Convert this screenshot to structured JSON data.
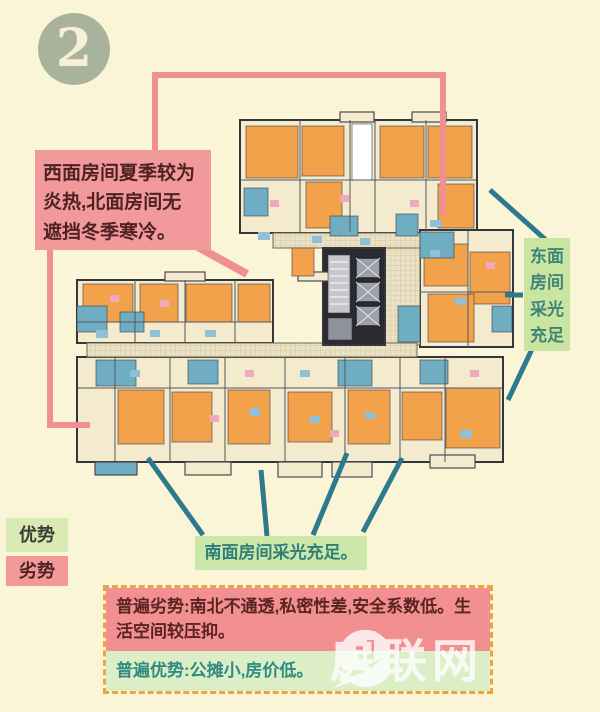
{
  "page": {
    "background": "#FBF5D8"
  },
  "badge": {
    "number": "2",
    "bg": "#A9B39B",
    "fg": "#F6F1D6"
  },
  "annotations": {
    "west_north": {
      "text": "西面房间夏季较为\n炎热,北面房间无\n遮挡冬季寒冷。",
      "bg": "#F29A9B",
      "fg": "#4D2221"
    },
    "east": {
      "text": "东面\n房间\n采光\n充足",
      "bg": "#CAE5A1",
      "fg": "#3E8577"
    },
    "south": {
      "text": "南面房间采光充足。",
      "bg": "#CBE7A9",
      "fg": "#2F7F78"
    }
  },
  "legend": {
    "advantage": {
      "label": "优势",
      "bg": "#D9EBB4",
      "fg": "#3C3C34"
    },
    "disadvantage": {
      "label": "劣势",
      "bg": "#F29899",
      "fg": "#4D2221"
    }
  },
  "summary": {
    "border_color": "#E9A53F",
    "disadvantage": {
      "text": "普遍劣势:南北不通透,私密性差,安全系数低。生活空间较压抑。",
      "bg": "#F28F90",
      "fg": "#5A2422"
    },
    "advantage": {
      "text": "普遍优势:公摊小,房价低。",
      "bg": "#DCEEC5",
      "fg": "#2F8A80"
    }
  },
  "watermark": {
    "text": "房联网",
    "color": "#FFFFFF"
  },
  "colors": {
    "c": "#F4EBCE",
    "o": "#F2A24A",
    "t": "#6FAEC2",
    "d": "#2A2A31",
    "w": "#FFFFFF",
    "h": "url(#hatch)",
    "g1": "#C6C6CC",
    "g2": "#9DA0A8",
    "g3": "#8F929B",
    "fb": "#8FC0D8",
    "fp": "#F0A8BC",
    "pink_line": "#F09092",
    "teal_line": "#2C7A8C"
  },
  "floorplan": {
    "blocks": [
      {
        "x": 240,
        "y": 120,
        "w": 237,
        "h": 113,
        "f": "c"
      },
      {
        "x": 420,
        "y": 230,
        "w": 93,
        "h": 117,
        "f": "c"
      },
      {
        "x": 77,
        "y": 280,
        "w": 196,
        "h": 63,
        "f": "c"
      },
      {
        "x": 77,
        "y": 357,
        "w": 426,
        "h": 105,
        "f": "c"
      },
      {
        "x": 273,
        "y": 233,
        "w": 147,
        "h": 15,
        "f": "h"
      },
      {
        "x": 385,
        "y": 248,
        "w": 35,
        "h": 97,
        "f": "h"
      },
      {
        "x": 87,
        "y": 343,
        "w": 330,
        "h": 14,
        "f": "h"
      },
      {
        "x": 323,
        "y": 248,
        "w": 62,
        "h": 97,
        "f": "d"
      }
    ],
    "balconies": [
      {
        "x": 340,
        "y": 112,
        "w": 34,
        "h": 10,
        "f": "c"
      },
      {
        "x": 412,
        "y": 112,
        "w": 34,
        "h": 10,
        "f": "c"
      },
      {
        "x": 165,
        "y": 272,
        "w": 40,
        "h": 9,
        "f": "c"
      },
      {
        "x": 298,
        "y": 272,
        "w": 34,
        "h": 9,
        "f": "c"
      },
      {
        "x": 95,
        "y": 462,
        "w": 42,
        "h": 13,
        "f": "t"
      },
      {
        "x": 185,
        "y": 462,
        "w": 46,
        "h": 13,
        "f": "c"
      },
      {
        "x": 278,
        "y": 462,
        "w": 44,
        "h": 15,
        "f": "c"
      },
      {
        "x": 332,
        "y": 462,
        "w": 40,
        "h": 15,
        "f": "c"
      },
      {
        "x": 430,
        "y": 455,
        "w": 45,
        "h": 13,
        "f": "c"
      }
    ],
    "rooms": [
      {
        "x": 246,
        "y": 126,
        "w": 52,
        "h": 52,
        "f": "o"
      },
      {
        "x": 302,
        "y": 126,
        "w": 42,
        "h": 50,
        "f": "o"
      },
      {
        "x": 380,
        "y": 126,
        "w": 44,
        "h": 52,
        "f": "o"
      },
      {
        "x": 428,
        "y": 126,
        "w": 44,
        "h": 52,
        "f": "o"
      },
      {
        "x": 306,
        "y": 182,
        "w": 36,
        "h": 46,
        "f": "o"
      },
      {
        "x": 438,
        "y": 184,
        "w": 36,
        "h": 44,
        "f": "o"
      },
      {
        "x": 352,
        "y": 124,
        "w": 20,
        "h": 56,
        "f": "w"
      },
      {
        "x": 244,
        "y": 188,
        "w": 24,
        "h": 28,
        "f": "t"
      },
      {
        "x": 330,
        "y": 216,
        "w": 28,
        "h": 20,
        "f": "t"
      },
      {
        "x": 396,
        "y": 214,
        "w": 22,
        "h": 22,
        "f": "t"
      },
      {
        "x": 424,
        "y": 244,
        "w": 44,
        "h": 42,
        "f": "o"
      },
      {
        "x": 470,
        "y": 252,
        "w": 40,
        "h": 52,
        "f": "o"
      },
      {
        "x": 428,
        "y": 294,
        "w": 46,
        "h": 48,
        "f": "o"
      },
      {
        "x": 292,
        "y": 248,
        "w": 22,
        "h": 28,
        "f": "o"
      },
      {
        "x": 420,
        "y": 232,
        "w": 34,
        "h": 26,
        "f": "t"
      },
      {
        "x": 492,
        "y": 306,
        "w": 20,
        "h": 26,
        "f": "t"
      },
      {
        "x": 398,
        "y": 306,
        "w": 22,
        "h": 36,
        "f": "t"
      },
      {
        "x": 83,
        "y": 284,
        "w": 50,
        "h": 38,
        "f": "o"
      },
      {
        "x": 140,
        "y": 284,
        "w": 38,
        "h": 38,
        "f": "o"
      },
      {
        "x": 186,
        "y": 284,
        "w": 46,
        "h": 38,
        "f": "o"
      },
      {
        "x": 238,
        "y": 284,
        "w": 32,
        "h": 38,
        "f": "o"
      },
      {
        "x": 77,
        "y": 306,
        "w": 30,
        "h": 26,
        "f": "t"
      },
      {
        "x": 120,
        "y": 312,
        "w": 24,
        "h": 20,
        "f": "t"
      },
      {
        "x": 118,
        "y": 390,
        "w": 46,
        "h": 54,
        "f": "o"
      },
      {
        "x": 172,
        "y": 392,
        "w": 40,
        "h": 50,
        "f": "o"
      },
      {
        "x": 228,
        "y": 390,
        "w": 42,
        "h": 54,
        "f": "o"
      },
      {
        "x": 288,
        "y": 392,
        "w": 44,
        "h": 50,
        "f": "o"
      },
      {
        "x": 348,
        "y": 390,
        "w": 42,
        "h": 54,
        "f": "o"
      },
      {
        "x": 402,
        "y": 392,
        "w": 40,
        "h": 48,
        "f": "o"
      },
      {
        "x": 446,
        "y": 388,
        "w": 54,
        "h": 60,
        "f": "o"
      },
      {
        "x": 96,
        "y": 360,
        "w": 40,
        "h": 26,
        "f": "t"
      },
      {
        "x": 188,
        "y": 360,
        "w": 30,
        "h": 24,
        "f": "t"
      },
      {
        "x": 338,
        "y": 360,
        "w": 34,
        "h": 26,
        "f": "t"
      },
      {
        "x": 420,
        "y": 360,
        "w": 28,
        "h": 24,
        "f": "t"
      }
    ],
    "furniture": [
      {
        "x": 258,
        "y": 232,
        "w": 12,
        "h": 8,
        "f": "fb"
      },
      {
        "x": 312,
        "y": 236,
        "w": 10,
        "h": 7,
        "f": "fb"
      },
      {
        "x": 430,
        "y": 220,
        "w": 12,
        "h": 7,
        "f": "fb"
      },
      {
        "x": 360,
        "y": 238,
        "w": 10,
        "h": 7,
        "f": "fb"
      },
      {
        "x": 455,
        "y": 298,
        "w": 11,
        "h": 7,
        "f": "fb"
      },
      {
        "x": 96,
        "y": 330,
        "w": 12,
        "h": 8,
        "f": "fb"
      },
      {
        "x": 150,
        "y": 330,
        "w": 10,
        "h": 7,
        "f": "fb"
      },
      {
        "x": 205,
        "y": 330,
        "w": 11,
        "h": 7,
        "f": "fb"
      },
      {
        "x": 250,
        "y": 408,
        "w": 10,
        "h": 8,
        "f": "fb"
      },
      {
        "x": 310,
        "y": 416,
        "w": 10,
        "h": 7,
        "f": "fb"
      },
      {
        "x": 365,
        "y": 412,
        "w": 10,
        "h": 7,
        "f": "fb"
      },
      {
        "x": 460,
        "y": 430,
        "w": 12,
        "h": 8,
        "f": "fb"
      },
      {
        "x": 130,
        "y": 370,
        "w": 10,
        "h": 7,
        "f": "fb"
      },
      {
        "x": 300,
        "y": 370,
        "w": 10,
        "h": 7,
        "f": "fb"
      },
      {
        "x": 430,
        "y": 250,
        "w": 10,
        "h": 7,
        "f": "fb"
      },
      {
        "x": 270,
        "y": 200,
        "w": 9,
        "h": 7,
        "f": "fp"
      },
      {
        "x": 340,
        "y": 195,
        "w": 9,
        "h": 7,
        "f": "fp"
      },
      {
        "x": 410,
        "y": 200,
        "w": 9,
        "h": 7,
        "f": "fp"
      },
      {
        "x": 486,
        "y": 262,
        "w": 9,
        "h": 7,
        "f": "fp"
      },
      {
        "x": 110,
        "y": 295,
        "w": 9,
        "h": 7,
        "f": "fp"
      },
      {
        "x": 160,
        "y": 300,
        "w": 9,
        "h": 7,
        "f": "fp"
      },
      {
        "x": 210,
        "y": 415,
        "w": 9,
        "h": 7,
        "f": "fp"
      },
      {
        "x": 330,
        "y": 430,
        "w": 9,
        "h": 7,
        "f": "fp"
      },
      {
        "x": 470,
        "y": 370,
        "w": 9,
        "h": 7,
        "f": "fp"
      },
      {
        "x": 245,
        "y": 370,
        "w": 9,
        "h": 7,
        "f": "fp"
      }
    ],
    "walls": [
      {
        "x1": 300,
        "y1": 120,
        "x2": 300,
        "y2": 232
      },
      {
        "x1": 350,
        "y1": 120,
        "x2": 350,
        "y2": 232
      },
      {
        "x1": 375,
        "y1": 120,
        "x2": 375,
        "y2": 232
      },
      {
        "x1": 426,
        "y1": 120,
        "x2": 426,
        "y2": 232
      },
      {
        "x1": 240,
        "y1": 180,
        "x2": 477,
        "y2": 180
      },
      {
        "x1": 420,
        "y1": 292,
        "x2": 513,
        "y2": 292
      },
      {
        "x1": 468,
        "y1": 230,
        "x2": 468,
        "y2": 347
      },
      {
        "x1": 135,
        "y1": 280,
        "x2": 135,
        "y2": 343
      },
      {
        "x1": 185,
        "y1": 280,
        "x2": 185,
        "y2": 343
      },
      {
        "x1": 235,
        "y1": 280,
        "x2": 235,
        "y2": 343
      },
      {
        "x1": 77,
        "y1": 322,
        "x2": 273,
        "y2": 322
      },
      {
        "x1": 115,
        "y1": 357,
        "x2": 115,
        "y2": 462
      },
      {
        "x1": 170,
        "y1": 357,
        "x2": 170,
        "y2": 462
      },
      {
        "x1": 225,
        "y1": 357,
        "x2": 225,
        "y2": 462
      },
      {
        "x1": 285,
        "y1": 357,
        "x2": 285,
        "y2": 462
      },
      {
        "x1": 345,
        "y1": 357,
        "x2": 345,
        "y2": 462
      },
      {
        "x1": 400,
        "y1": 357,
        "x2": 400,
        "y2": 462
      },
      {
        "x1": 445,
        "y1": 357,
        "x2": 445,
        "y2": 462
      },
      {
        "x1": 77,
        "y1": 388,
        "x2": 503,
        "y2": 388
      }
    ],
    "stairwell": {
      "x": 328,
      "y": 255,
      "w": 22,
      "h": 58,
      "f": "g1",
      "steps_y": [
        262,
        269,
        276,
        283,
        290,
        297,
        304
      ]
    },
    "elevators": [
      {
        "x": 356,
        "y": 258,
        "w": 24,
        "h": 20,
        "f": "g2"
      },
      {
        "x": 356,
        "y": 282,
        "w": 24,
        "h": 20,
        "f": "g2"
      },
      {
        "x": 356,
        "y": 306,
        "w": 24,
        "h": 20,
        "f": "g2"
      }
    ],
    "core_floor": {
      "x": 328,
      "y": 318,
      "w": 24,
      "h": 22,
      "f": "g3"
    },
    "connectors": {
      "pink_polylines": [
        [
          [
            155,
            150
          ],
          [
            155,
            75
          ],
          [
            443,
            75
          ],
          [
            443,
            215
          ]
        ],
        [
          [
            50,
            250
          ],
          [
            50,
            425
          ],
          [
            90,
            425
          ]
        ]
      ],
      "pink_arrows": [
        [
          [
            198,
            247
          ],
          [
            247,
            274
          ]
        ]
      ],
      "teal_lines": [
        {
          "x1": 148,
          "y1": 458,
          "x2": 203,
          "y2": 535
        },
        {
          "x1": 261,
          "y1": 470,
          "x2": 267,
          "y2": 536
        },
        {
          "x1": 347,
          "y1": 453,
          "x2": 313,
          "y2": 535
        },
        {
          "x1": 402,
          "y1": 458,
          "x2": 363,
          "y2": 532
        },
        {
          "x1": 490,
          "y1": 190,
          "x2": 547,
          "y2": 241
        },
        {
          "x1": 505,
          "y1": 295,
          "x2": 523,
          "y2": 295
        },
        {
          "x1": 533,
          "y1": 347,
          "x2": 508,
          "y2": 400
        }
      ]
    }
  }
}
